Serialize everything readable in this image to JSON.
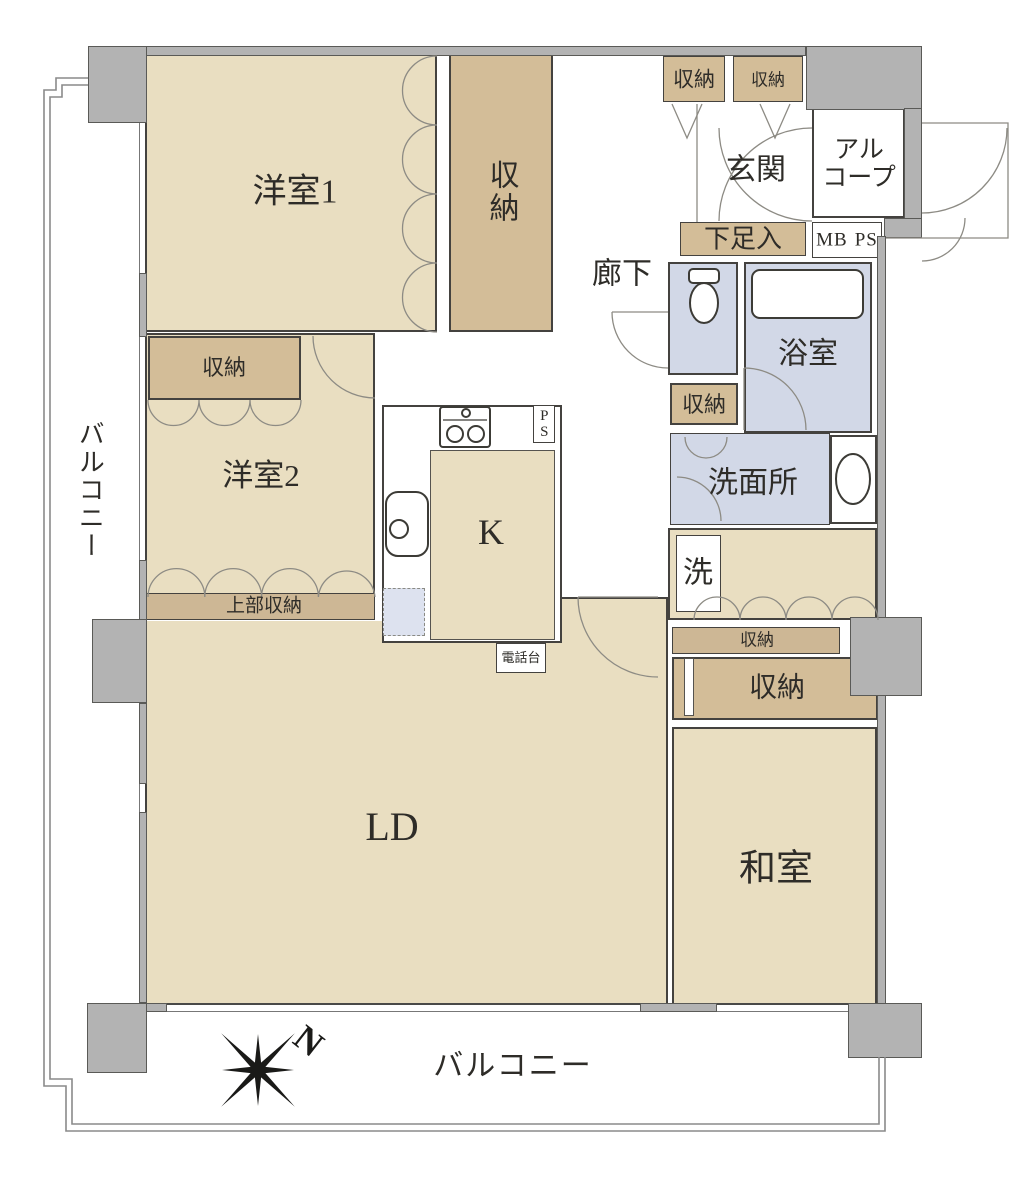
{
  "plan": {
    "rooms": {
      "yoshitsu1": "洋室1",
      "yoshitsu2": "洋室2",
      "washitsu": "和室",
      "ld": "LD",
      "kitchen_k": "K",
      "genkan": "玄関",
      "rouka": "廊下",
      "alcove_line1": "アル",
      "alcove_line2": "コープ",
      "yokushitsu": "浴室",
      "senmenjo": "洗面所",
      "laundry_sen": "洗"
    },
    "storage": {
      "shunou": "収納",
      "joubu_shunou": "上部収納",
      "shitasoku_iri": "下足入"
    },
    "utility": {
      "mb": "MB",
      "ps": "PS",
      "denwadai": "電話台"
    },
    "balcony": {
      "label": "バルコニー"
    },
    "compass": {
      "north": "N"
    },
    "colors": {
      "room_beige": "#e9dec1",
      "storage_tan": "#d3bd98",
      "strip_tan": "#cdb795",
      "wet_blue": "#d2d8e7",
      "wall_gray": "#b3b3b3",
      "line_dark": "#44423f"
    }
  }
}
